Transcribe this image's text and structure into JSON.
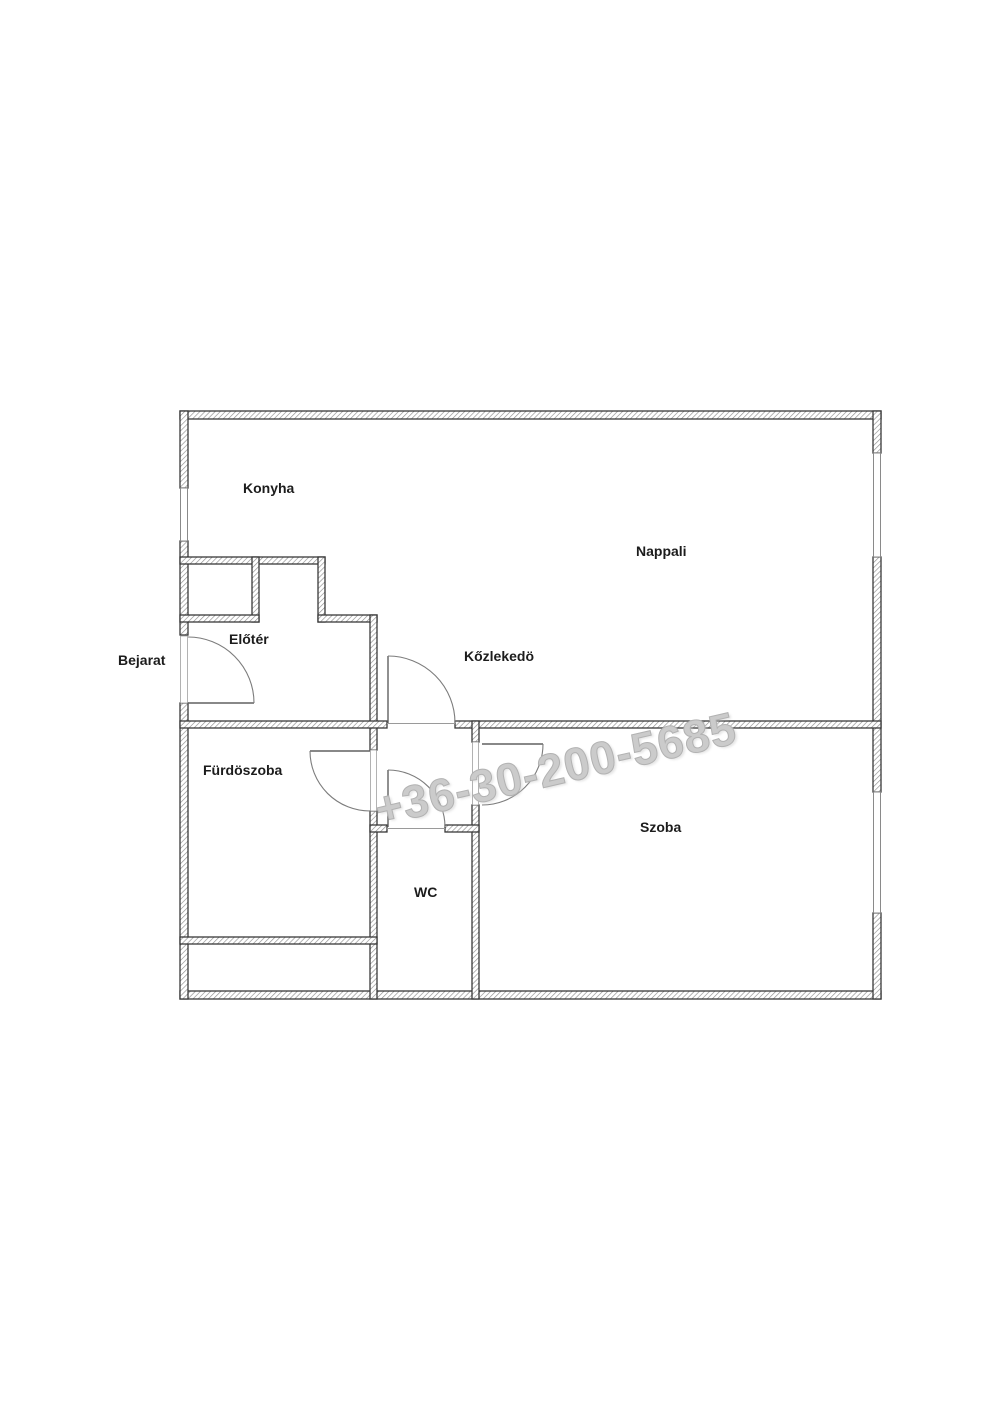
{
  "plan": {
    "watermark": "+36-30-200-5685",
    "entrance": {
      "label": "Bejarat"
    },
    "rooms": [
      {
        "name": "konyha",
        "label": "Konyha"
      },
      {
        "name": "nappali",
        "label": "Nappali"
      },
      {
        "name": "eloter",
        "label": "Előtér"
      },
      {
        "name": "kozlekedo",
        "label": "Kőzlekedö"
      },
      {
        "name": "furdoszoba",
        "label": "Fürdöszoba"
      },
      {
        "name": "wc",
        "label": "WC"
      },
      {
        "name": "szoba",
        "label": "Szoba"
      }
    ],
    "colors": {
      "wall_line": "#383838",
      "wall_hatch": "#8f8f8f",
      "label_text": "#1c1c1c",
      "watermark": "#cbcbcb",
      "background": "#ffffff"
    }
  }
}
